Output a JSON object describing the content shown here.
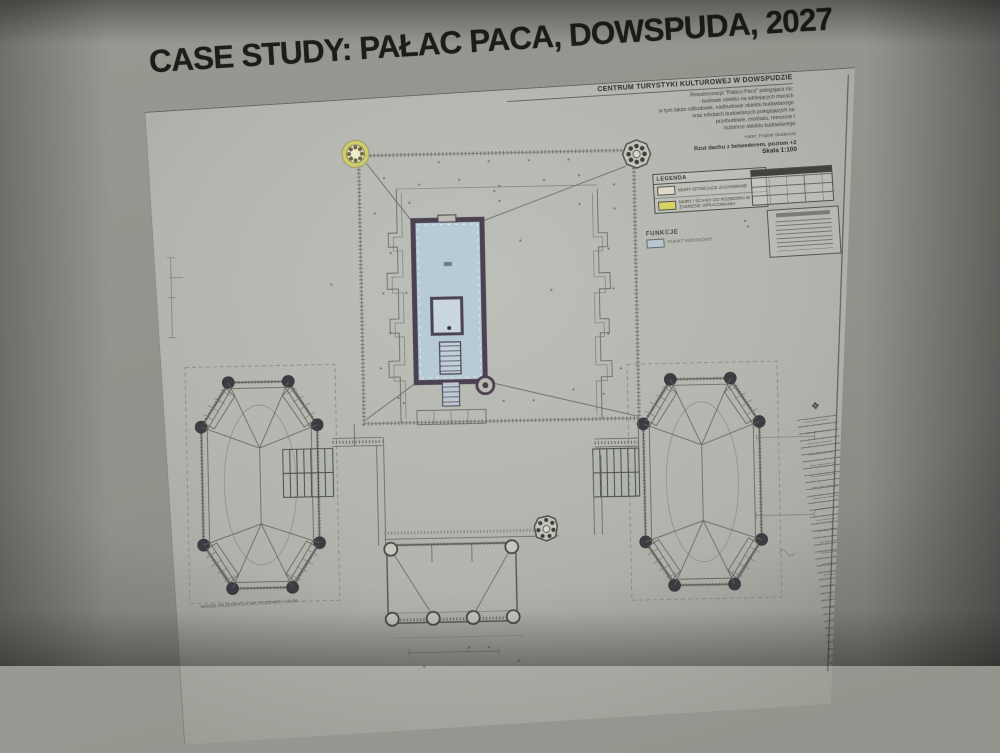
{
  "slide": {
    "title": "CASE STUDY: PAŁAC PACA, DOWSPUDA, 2027"
  },
  "sheet": {
    "header": {
      "title": "CENTRUM TURYSTYKI KULTUROWEJ  W DOWSPUDZIE",
      "lines": [
        "Rewaloryzacja \"Pałacu Paca\" polegająca na:",
        "- budowie obiektu na istniejących murach",
        "w tym także odbudowie, nadbudowie obiektu budowlanego",
        "oraz robotach budowlanych polegających na",
        "przebudowie, montażu, remoncie i",
        "rozbiórce obiektu budowlanego"
      ],
      "author": "Autor: Projekt Studencki",
      "drawing_title": "Rzut dachu z belwederem, poziom +2",
      "scale": "Skala 1:100"
    },
    "legend": {
      "title": "LEGENDA",
      "items": [
        {
          "label": "MURY ISTNIEJĄCE ZACHOWANE"
        },
        {
          "label": "MURY / ŚCIANY DO ROZBIÓRKI W ZAKRESIE OPRACOWANIA"
        }
      ]
    },
    "functions": {
      "title": "FUNKCJE",
      "items": [
        {
          "label": "PUNKT WIDOKOWY"
        }
      ]
    },
    "caption_left_wing": "WIDOK PRZEKRYCIA NA POZIOMIE +16,80"
  },
  "colors": {
    "yellow": "#d6d264",
    "blue": "#b7cbd6",
    "wall": "#4c4150",
    "ivory": "#dcd9c8",
    "sheet": "#b2b4ae",
    "ink": "#44453f"
  }
}
